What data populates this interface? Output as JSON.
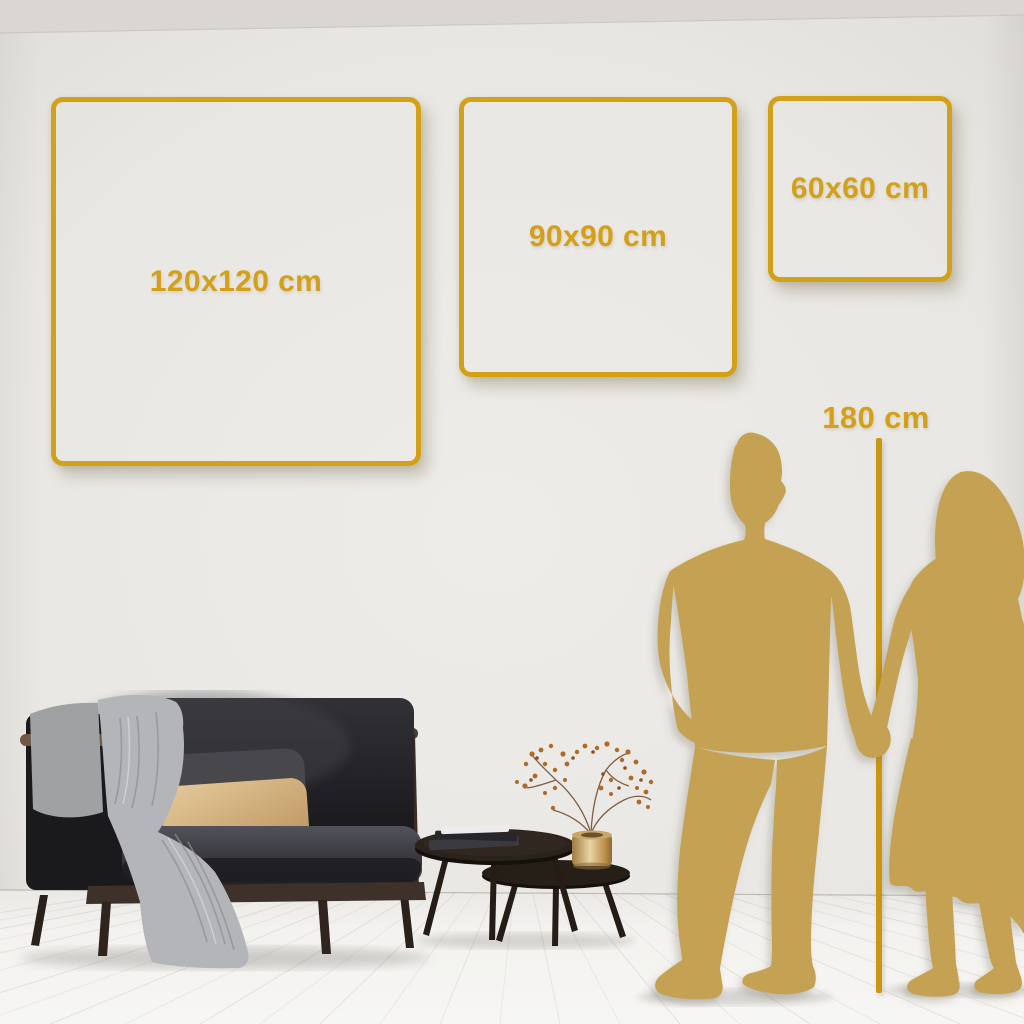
{
  "colors": {
    "frame_gold": "#D3A118",
    "label_gold": "#D2A01A",
    "ruler_gold": "#CB9712",
    "silhouette_gold": "#C5A252",
    "wall": "#E9E7E3",
    "floor": "#F3F2EF"
  },
  "size_frames": [
    {
      "label": "120x120 cm",
      "width_cm": 120,
      "height_cm": 120
    },
    {
      "label": "90x90 cm",
      "width_cm": 90,
      "height_cm": 90
    },
    {
      "label": "60x60 cm",
      "width_cm": 60,
      "height_cm": 60
    }
  ],
  "height_ruler": {
    "label": "180 cm",
    "height_cm": 180
  },
  "illustrations": {
    "couple": "couple-silhouette-holding-hands",
    "sofa": "dark-sofa-with-gray-blanket-and-pillows",
    "coffee_tables": "nesting-coffee-tables-with-books-and-brass-vase",
    "plant": "decorative-branch-with-rust-flowers"
  }
}
